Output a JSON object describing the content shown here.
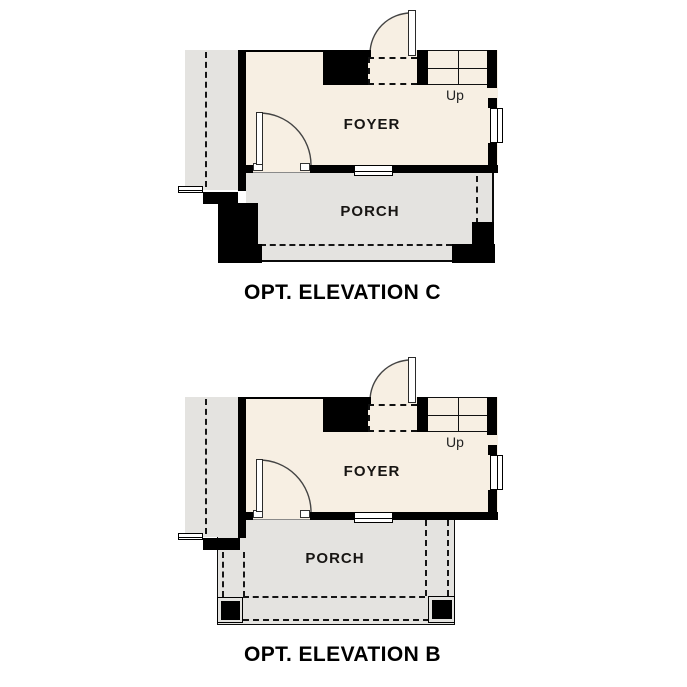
{
  "colors": {
    "background": "#ffffff",
    "foyer_fill": "#f7efe3",
    "porch_fill": "#e4e3e0",
    "wall": "#000000"
  },
  "plans": [
    {
      "caption": "OPT. ELEVATION C",
      "rooms": {
        "foyer": "FOYER",
        "porch": "PORCH"
      },
      "stairs_direction": "Up"
    },
    {
      "caption": "OPT. ELEVATION B",
      "rooms": {
        "foyer": "FOYER",
        "porch": "PORCH"
      },
      "stairs_direction": "Up"
    }
  ]
}
